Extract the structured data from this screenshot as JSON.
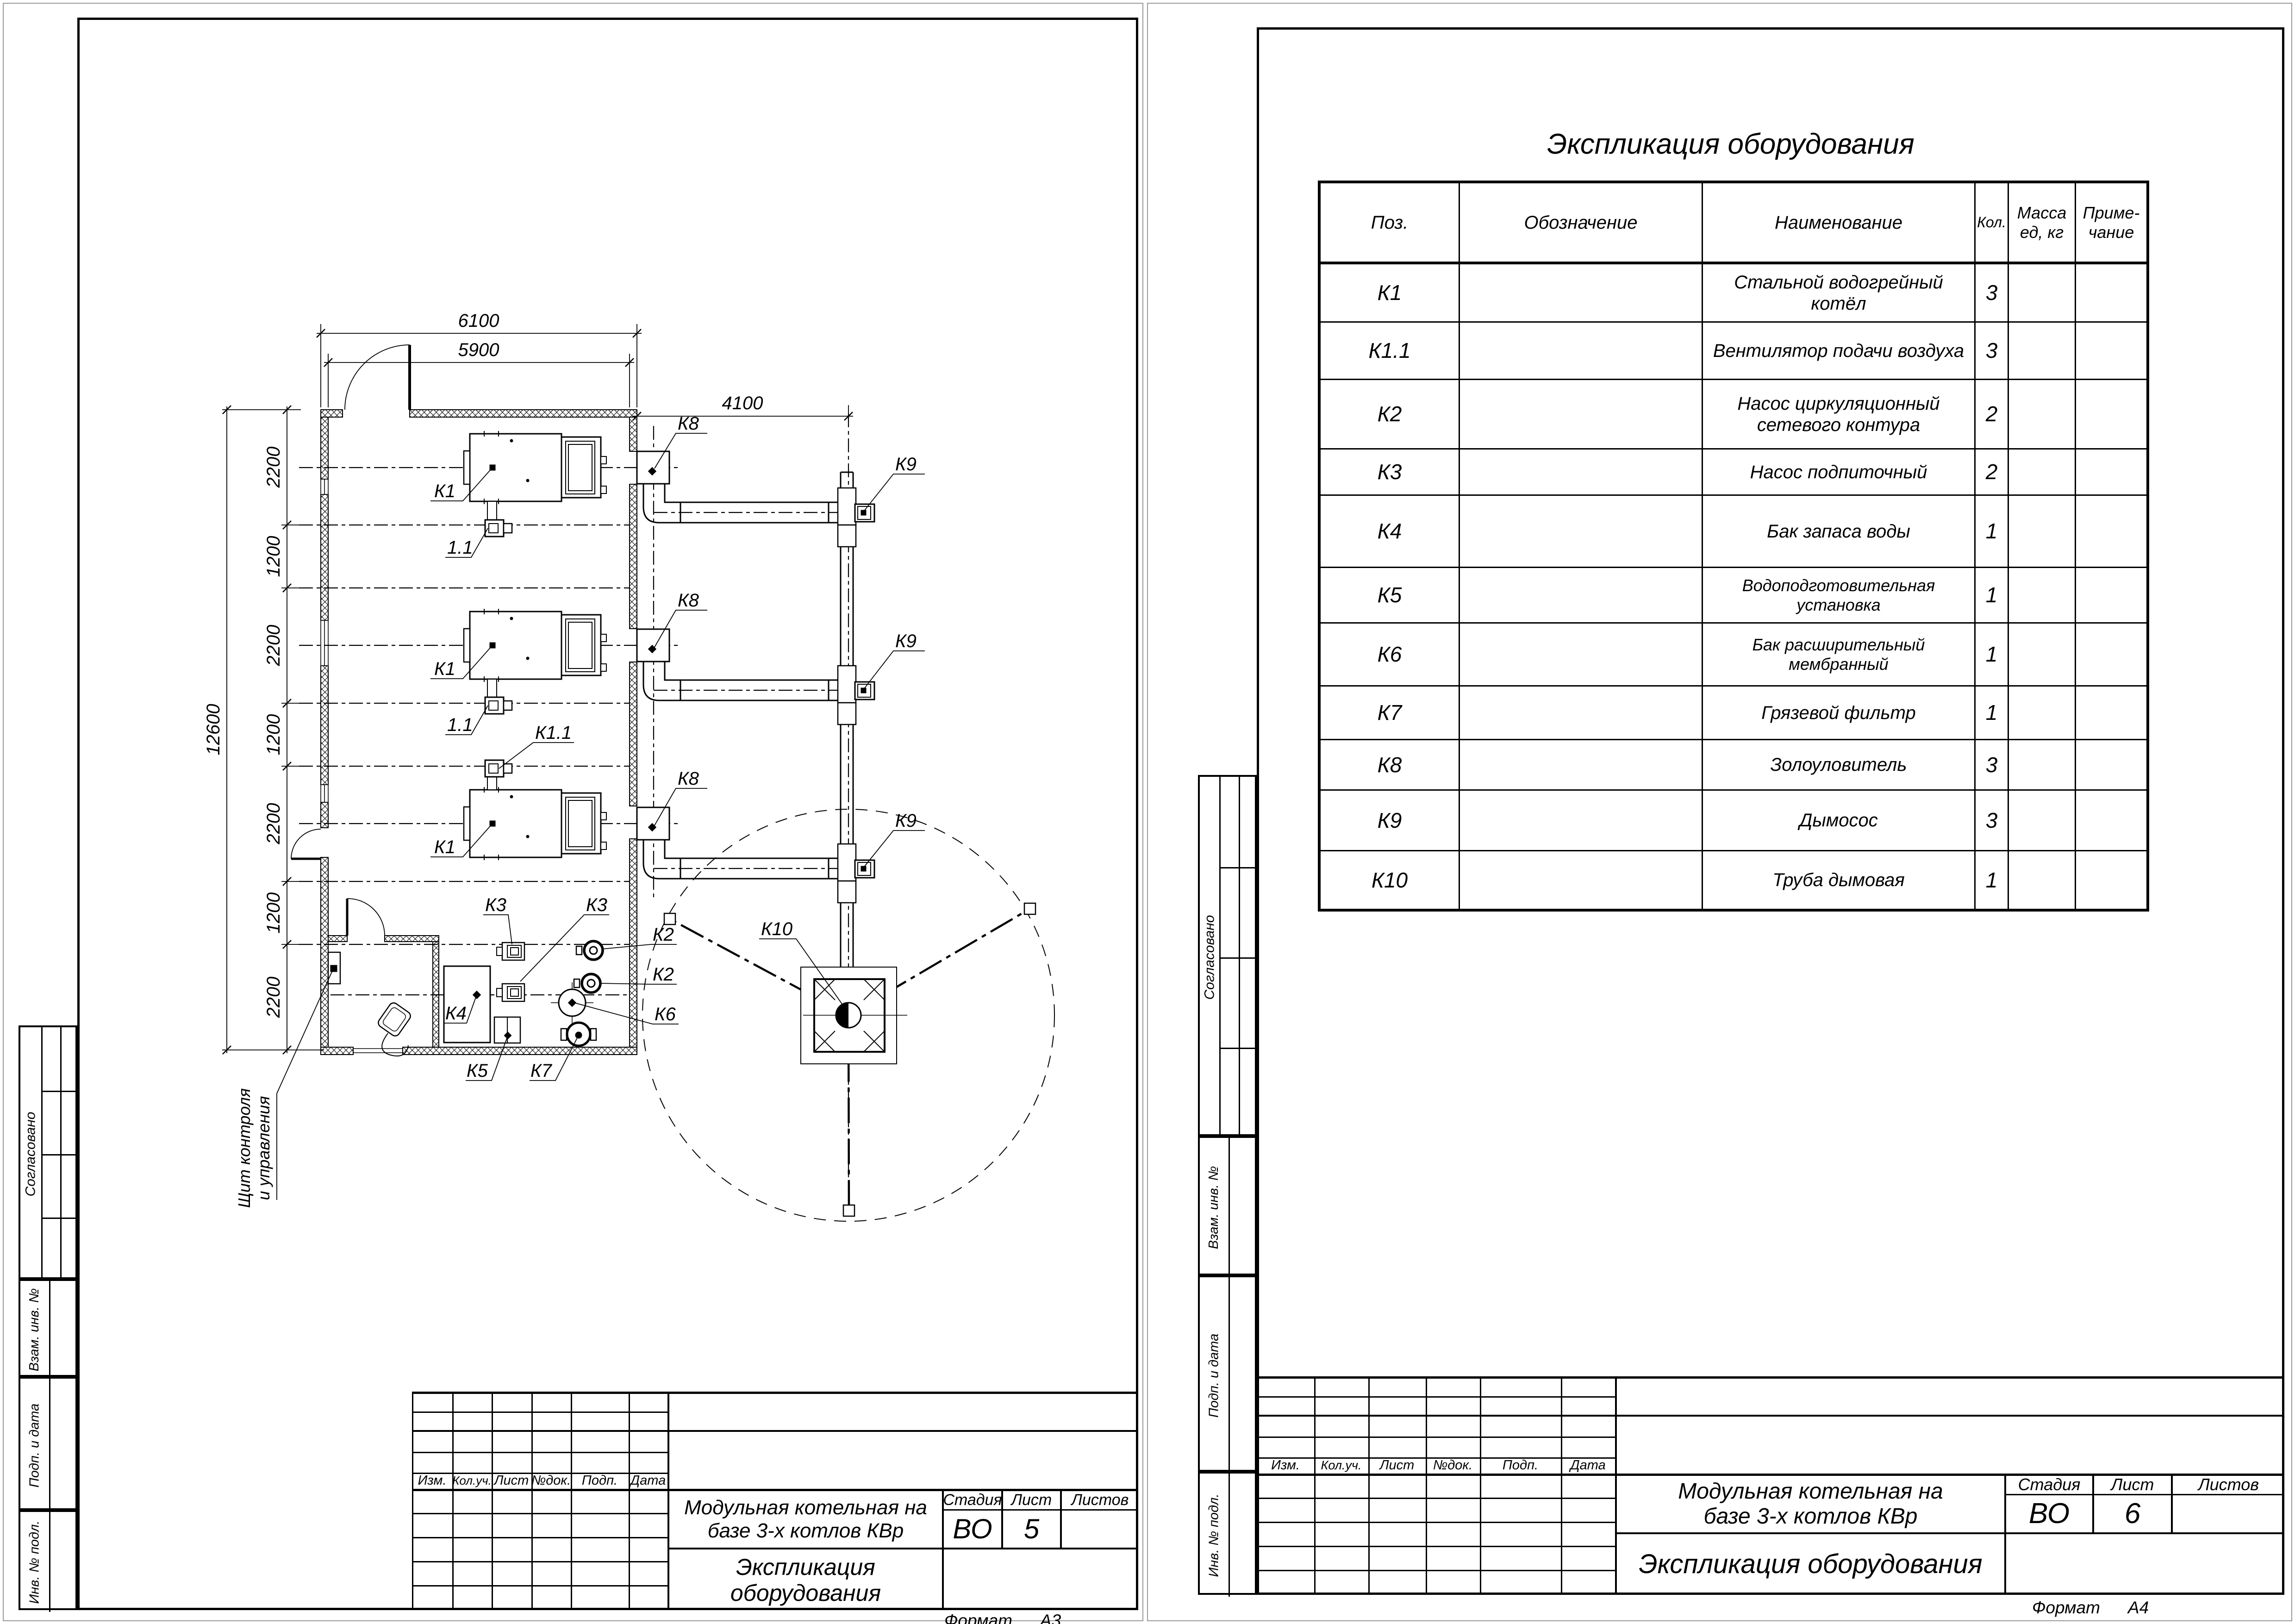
{
  "sheets": {
    "left": {
      "stamp": {
        "approved": "Согласовано",
        "replace_inv": "Взам. инв. №",
        "sign_date": "Подп. и дата",
        "inv_no": "Инв. № подл."
      },
      "titleblock": {
        "rev": {
          "izm": "Изм.",
          "kol": "Кол.уч.",
          "list": "Лист",
          "dok": "№док.",
          "podp": "Подп.",
          "data": "Дата"
        },
        "project_l1": "Модульная котельная на",
        "project_l2": "базе 3-х котлов КВр",
        "stage_h": "Стадия",
        "sheet_h": "Лист",
        "sheets_h": "Листов",
        "stage": "ВО",
        "sheet": "5",
        "sheets_total": "",
        "doc": "Экспликация оборудования"
      },
      "format_label": "Формат",
      "format_value": "А3",
      "plan": {
        "dims": {
          "w_out": "6100",
          "w_in": "5900",
          "offset": "4100",
          "h_total": "12600",
          "seg_a": "2200",
          "seg_b": "1200"
        },
        "labels": {
          "k1": "К1",
          "k11": "К1.1",
          "fan": "1.1",
          "k2": "К2",
          "k3": "К3",
          "k4": "К4",
          "k5": "К5",
          "k6": "К6",
          "k7": "К7",
          "k8": "К8",
          "k9": "К9",
          "k10": "К10"
        },
        "panel_l1": "Щит контроля",
        "panel_l2": "и управления"
      }
    },
    "right": {
      "stamp": {
        "approved": "Согласовано",
        "replace_inv": "Взам. инв. №",
        "sign_date": "Подп. и дата",
        "inv_no": "Инв. № подл."
      },
      "table": {
        "title": "Экспликация оборудования",
        "h_pos": "Поз.",
        "h_desig": "Обозначение",
        "h_name": "Наименование",
        "h_qty": "Кол.",
        "h_mass_l1": "Масса",
        "h_mass_l2": "ед, кг",
        "h_note_l1": "Приме-",
        "h_note_l2": "чание",
        "rows": [
          {
            "pos": "К1",
            "name": "Стальной водогрейный котёл",
            "qty": "3"
          },
          {
            "pos": "К1.1",
            "name": "Вентилятор подачи воздуха",
            "qty": "3"
          },
          {
            "pos": "К2",
            "name": "Насос циркуляционный сетевого контура",
            "qty": "2"
          },
          {
            "pos": "К3",
            "name": "Насос подпиточный",
            "qty": "2"
          },
          {
            "pos": "К4",
            "name": "Бак запаса воды",
            "qty": "1"
          },
          {
            "pos": "К5",
            "name": "Водоподготовительная установка",
            "qty": "1"
          },
          {
            "pos": "К6",
            "name": "Бак расширительный мембранный",
            "qty": "1"
          },
          {
            "pos": "К7",
            "name": "Грязевой фильтр",
            "qty": "1"
          },
          {
            "pos": "К8",
            "name": "Золоуловитель",
            "qty": "3"
          },
          {
            "pos": "К9",
            "name": "Дымосос",
            "qty": "3"
          },
          {
            "pos": "К10",
            "name": "Труба дымовая",
            "qty": "1"
          }
        ]
      },
      "titleblock": {
        "rev": {
          "izm": "Изм.",
          "kol": "Кол.уч.",
          "list": "Лист",
          "dok": "№док.",
          "podp": "Подп.",
          "data": "Дата"
        },
        "project_l1": "Модульная котельная на",
        "project_l2": "базе 3-х котлов КВр",
        "stage_h": "Стадия",
        "sheet_h": "Лист",
        "sheets_h": "Листов",
        "stage": "ВО",
        "sheet": "6",
        "sheets_total": "",
        "doc": "Экспликация оборудования"
      },
      "format_label": "Формат",
      "format_value": "А4"
    }
  }
}
